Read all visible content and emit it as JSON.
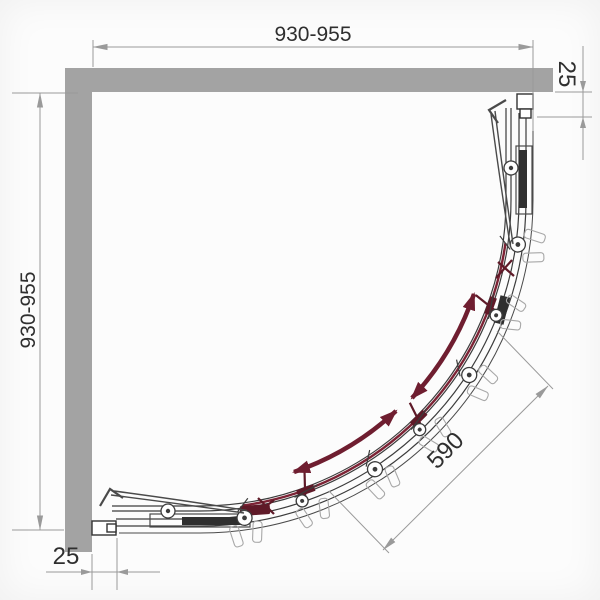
{
  "dims": {
    "top": "930-955",
    "left": "930-955",
    "right_offset": "25",
    "bottom_offset": "25",
    "entry": "590"
  },
  "icons": {
    "slide_direction_arrow": "curved-double-headed-arrow",
    "roller": "wheel-circle",
    "handle": "hooked-curve"
  },
  "colors": {
    "wall": "#a3a3a3",
    "line": "#3c3c3c",
    "dim_line": "#9a9a9a",
    "text": "#2f2f2f",
    "accent": "#6f1e30",
    "door": "#7c2335",
    "background": "#fcfcfc"
  }
}
